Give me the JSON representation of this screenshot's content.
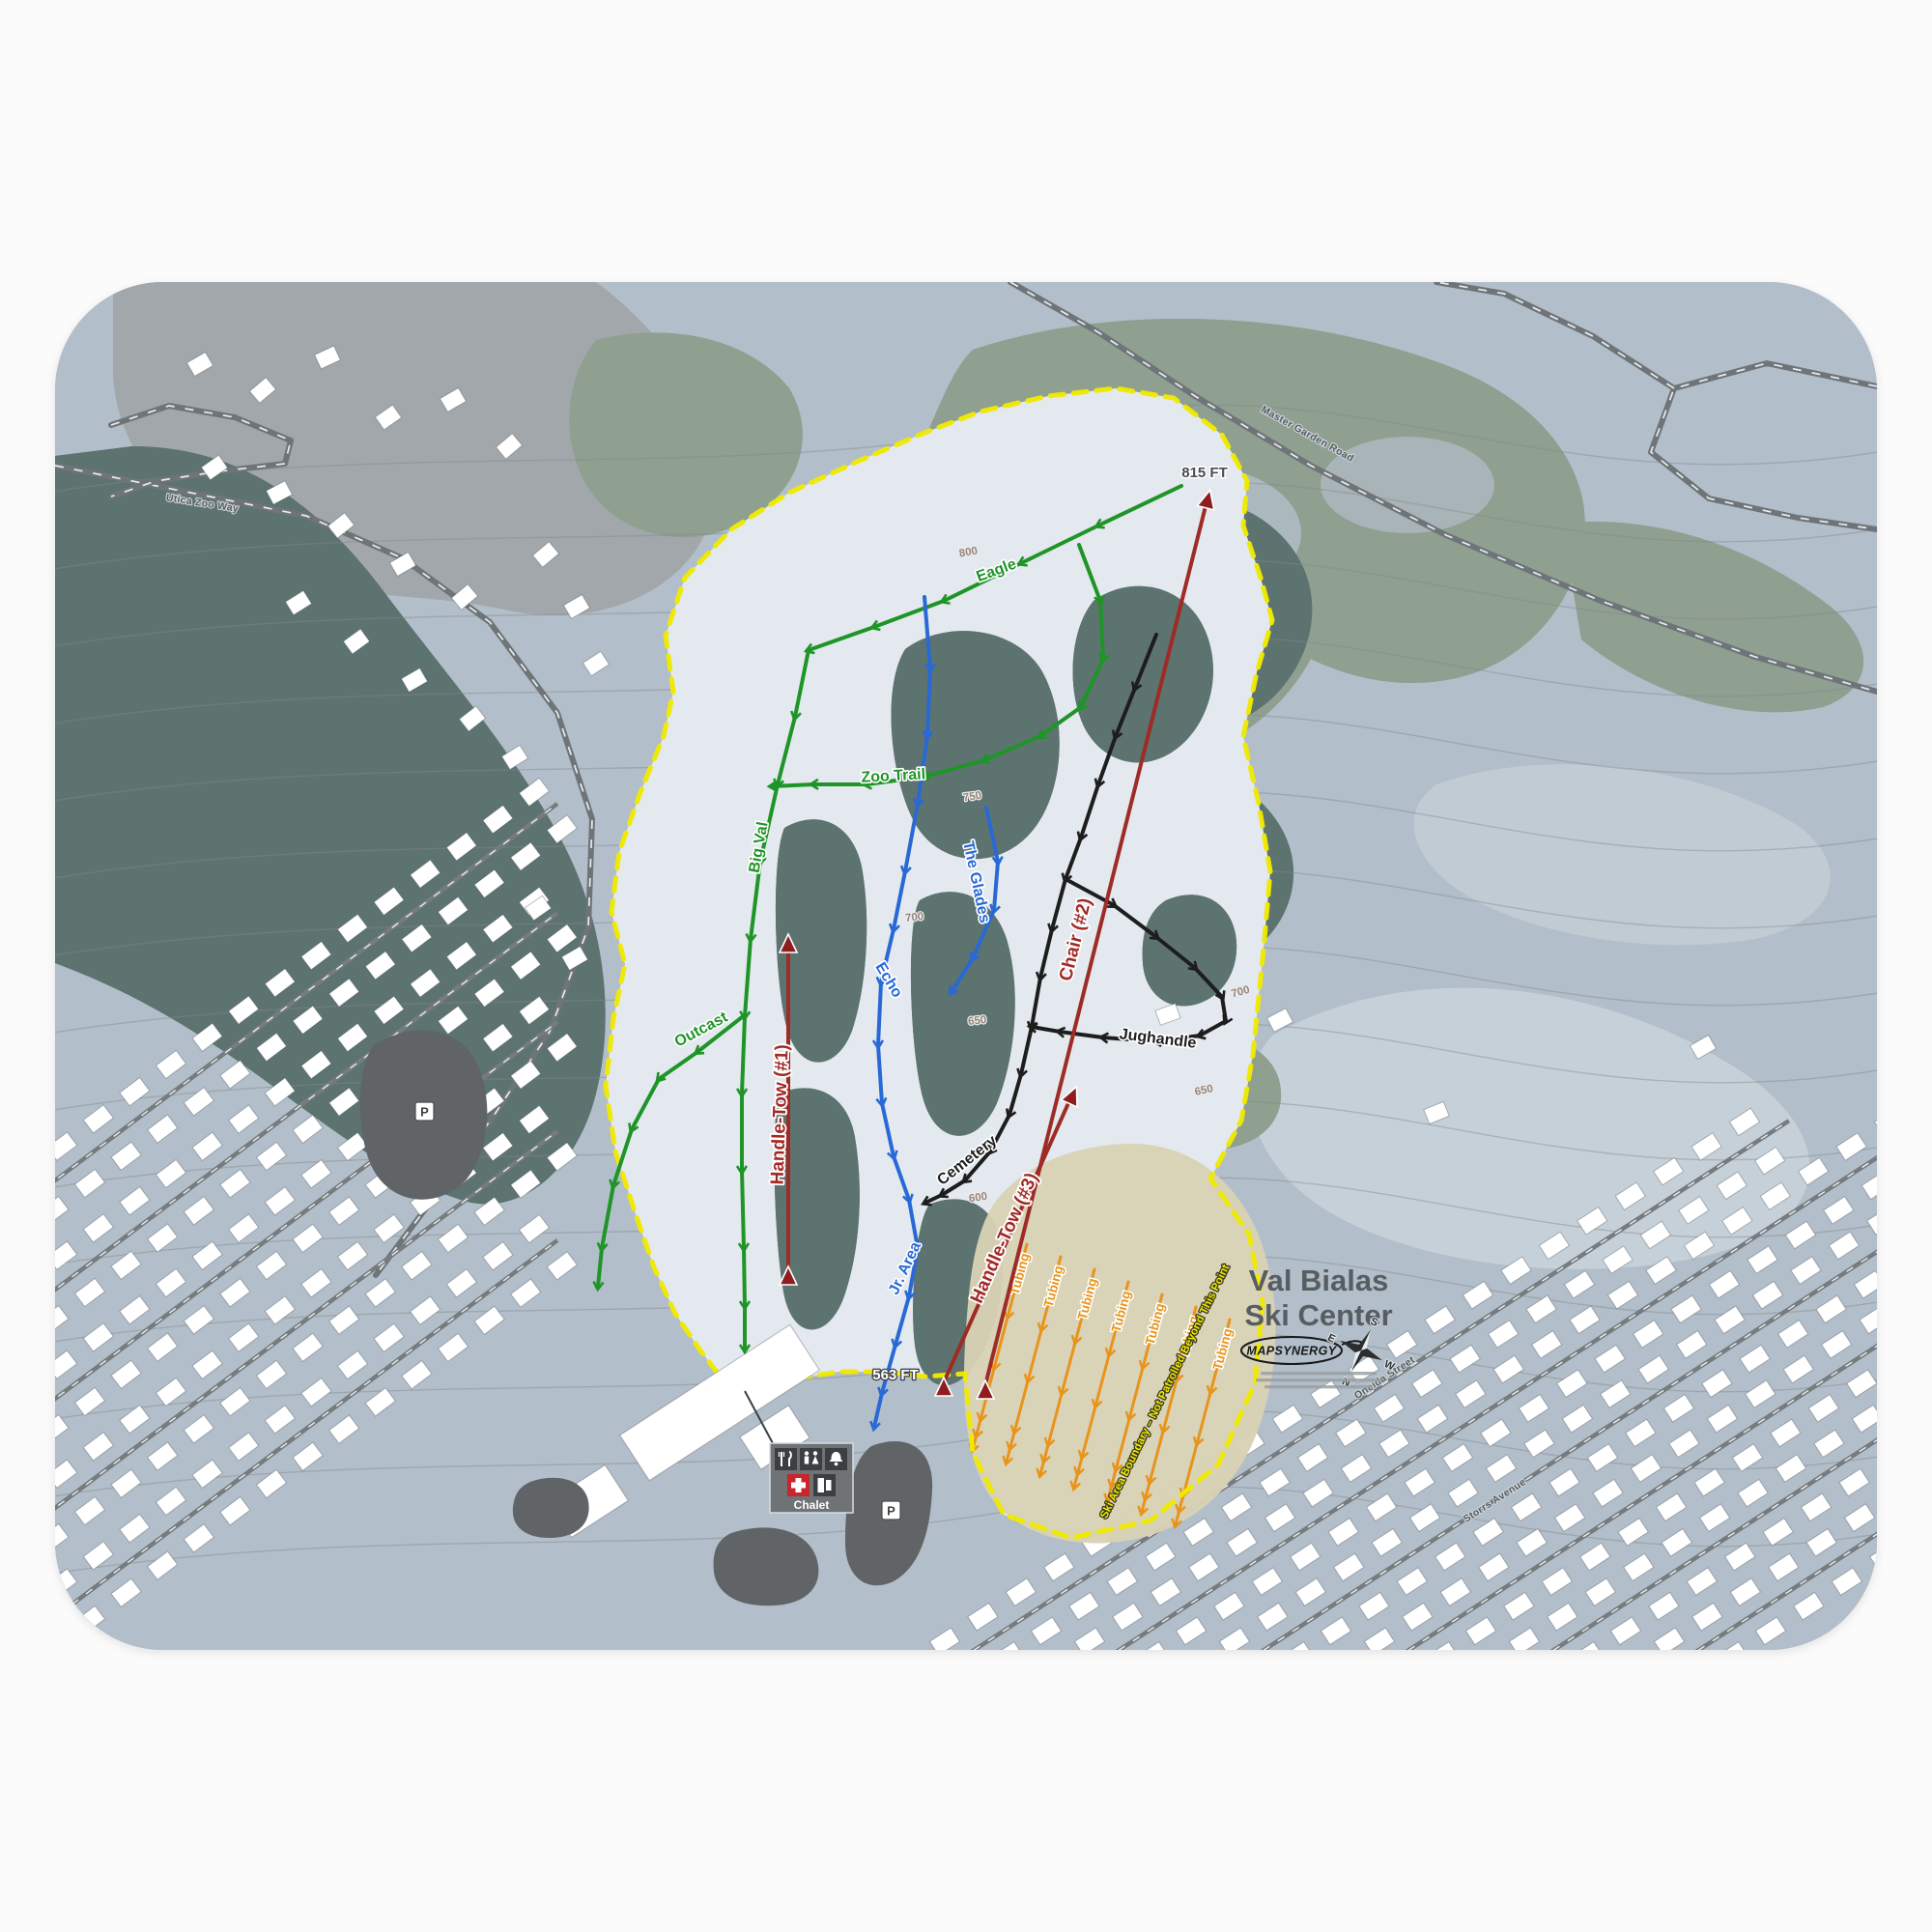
{
  "title": {
    "line1": "Val Bialas",
    "line2": "Ski Center"
  },
  "branding": {
    "logo": "MAPSYNERGY"
  },
  "compass": {
    "n": "N",
    "e": "E",
    "s": "S",
    "w": "W"
  },
  "elevations": {
    "summit": "815 FT",
    "base": "563 FT"
  },
  "lifts": [
    {
      "name": "Handle-Tow (#1)",
      "type": "surface-lift"
    },
    {
      "name": "Chair (#2)",
      "type": "chairlift"
    },
    {
      "name": "Handle-Tow (#3)",
      "type": "surface-lift"
    }
  ],
  "trails": {
    "green": [
      "Eagle",
      "Zoo Trail",
      "Big Val",
      "Outcast"
    ],
    "blue": [
      "Echo",
      "The Glades",
      "Jr. Area"
    ],
    "black": [
      "Cemetery",
      "Jughandle"
    ]
  },
  "tubing": {
    "label": "Tubing",
    "lane_count": 7
  },
  "boundary": {
    "label": "Ski Area Boundary – Not Patrolled Beyond This Point"
  },
  "contour_labels": [
    "800",
    "750",
    "700",
    "650",
    "600",
    "700",
    "650"
  ],
  "streets": {
    "master_garden": "Master Garden Road",
    "utica_zoo": "Utica Zoo Way",
    "oneida": "Oneida Street",
    "storrs": "Storrs Avenue"
  },
  "base_area": {
    "chalet": "Chalet",
    "parking": "P"
  },
  "colors": {
    "trail_green": "#1f9427",
    "trail_blue": "#2969d6",
    "trail_black": "#1d1d1d",
    "lift_red": "#a12a26",
    "tubing_orange": "#e8941a",
    "boundary_yellow": "#f0e900"
  }
}
